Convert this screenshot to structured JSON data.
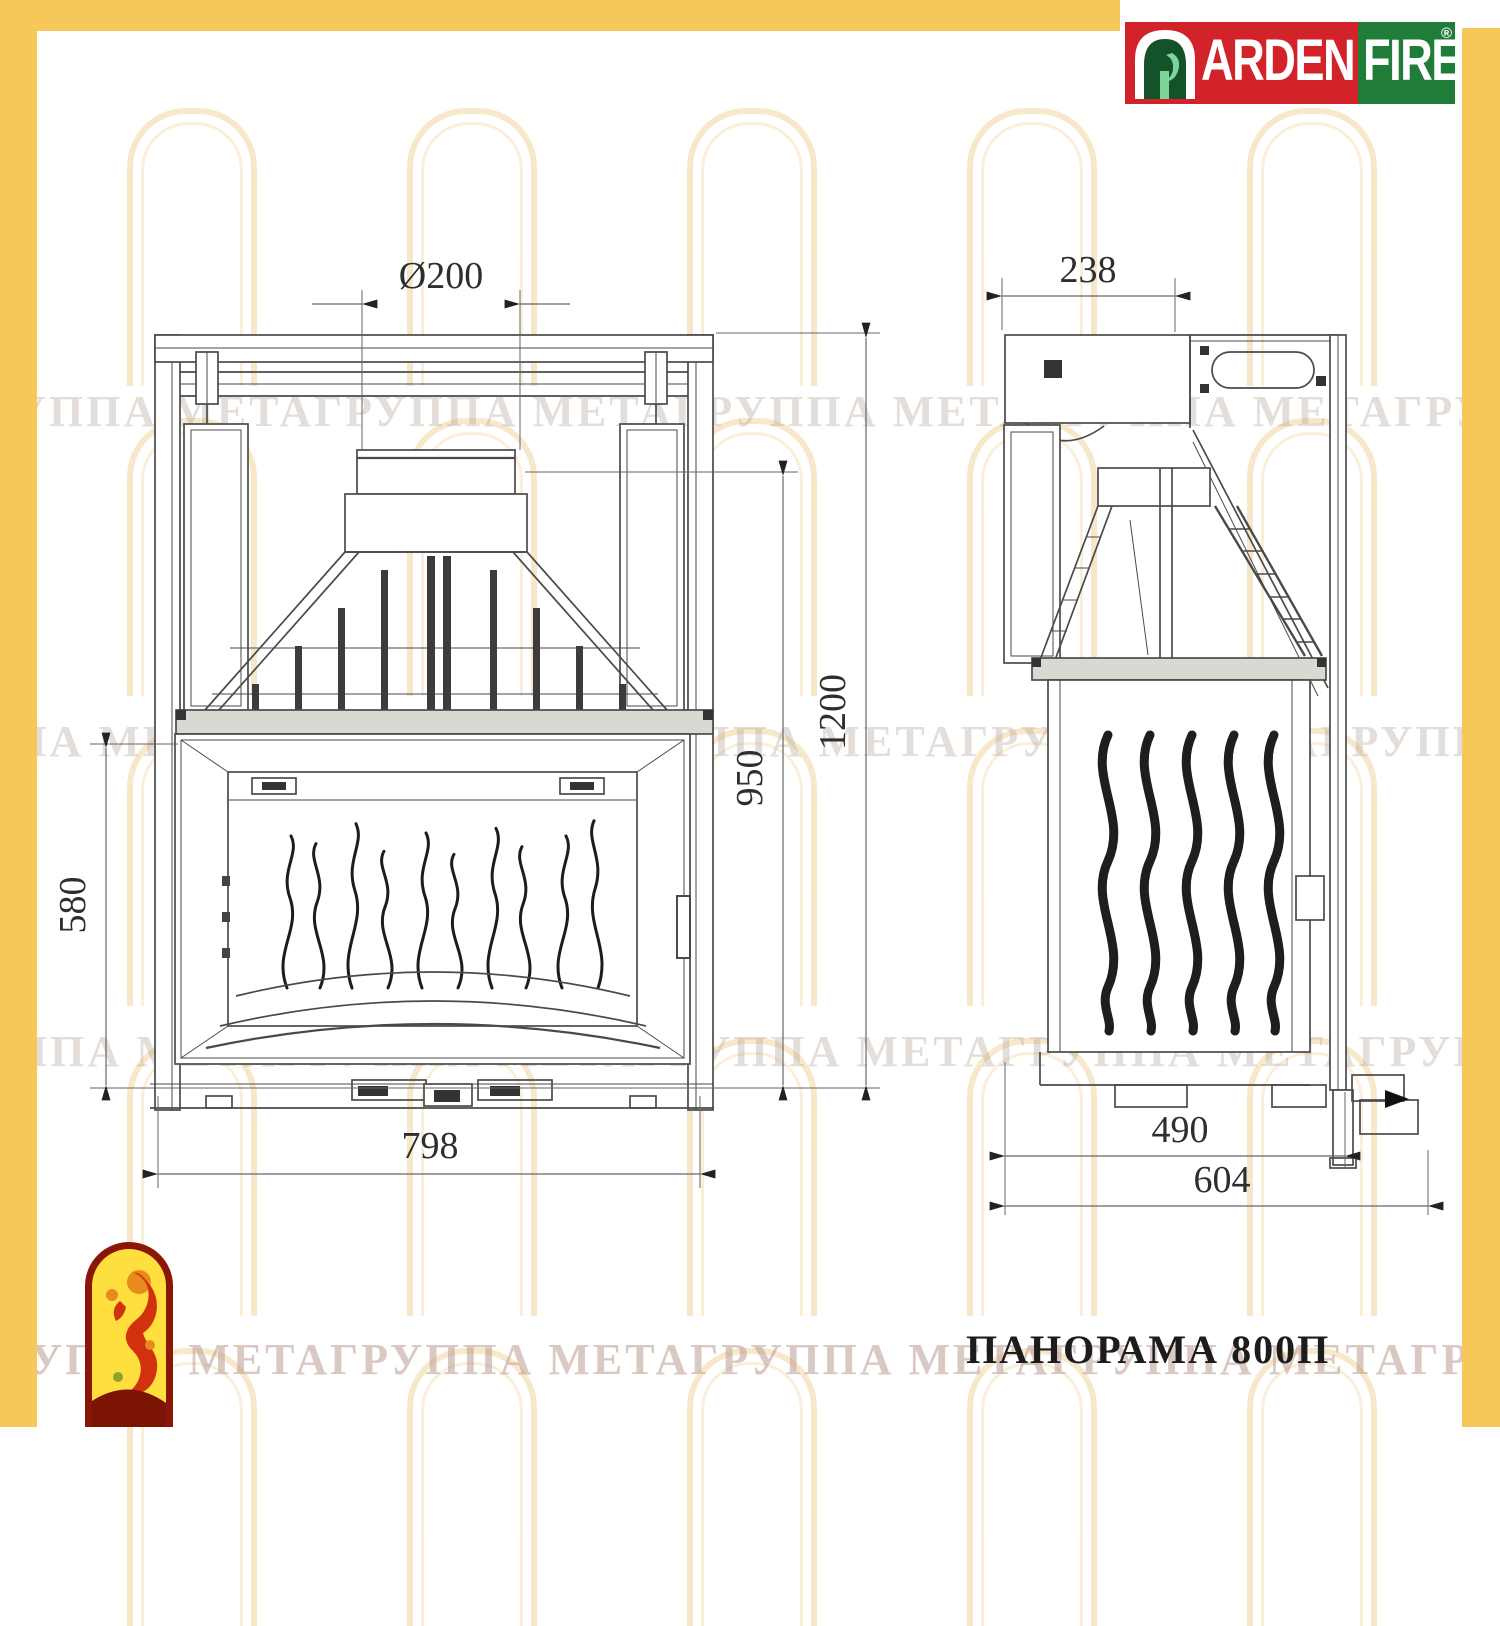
{
  "brand": {
    "arden": "ARDEN",
    "fire": "FIRE",
    "registered": "®"
  },
  "title": "ПАНОРАМА 800П",
  "watermark_text": "ГРУППА МЕТАГРУППА МЕТАГРУППА МЕТАГРУППА МЕТАГРУППА МЕТАГРУППА МЕТА",
  "front_view": {
    "dim_flue_diameter": "Ø200",
    "dim_total_height": "1200",
    "dim_inner_height": "950",
    "dim_firebox_height": "580",
    "dim_width": "798"
  },
  "side_view": {
    "dim_top_depth": "238",
    "dim_body_depth": "490",
    "dim_total_depth": "604"
  },
  "colors": {
    "frame_yellow": "#f6c85a",
    "logo_red": "#d2232a",
    "logo_green": "#1f7c39"
  }
}
